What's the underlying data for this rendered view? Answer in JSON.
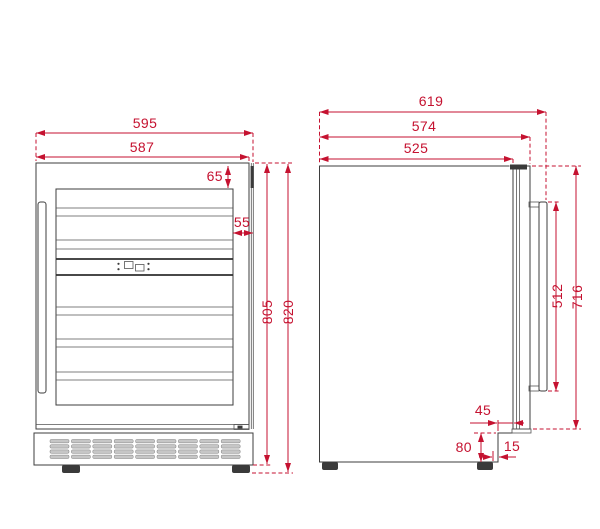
{
  "diagram": {
    "type": "technical-drawing",
    "subject": "Built-in wine cooler dimensional drawing with front view and side view",
    "units": "mm",
    "colors": {
      "dimension_red": "#c51230",
      "line_dark": "#3d3d3d",
      "background": "#ffffff"
    },
    "front_view": {
      "dims": {
        "total_width": "595",
        "door_width": "587",
        "top_inset": "65",
        "right_inset": "55",
        "body_height": "805",
        "total_height": "820"
      }
    },
    "side_view": {
      "dims": {
        "total_depth": "619",
        "depth_with_door": "574",
        "body_depth": "525",
        "handle_length": "512",
        "door_height": "716",
        "door_clearance": "45",
        "plinth_height": "80",
        "foot_inset": "15"
      }
    }
  }
}
